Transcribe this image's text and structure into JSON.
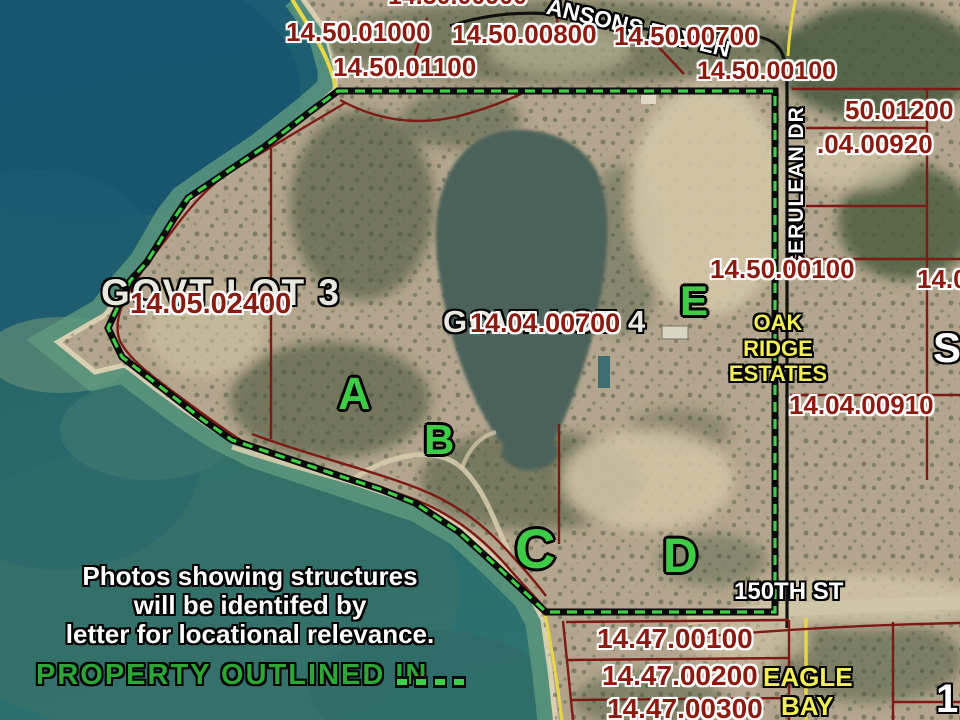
{
  "parcels": {
    "p14_50_00900": "14.50.00900",
    "p14_50_01000": "14.50.01000",
    "p14_50_00800": "14.50.00800",
    "p14_50_00700": "14.50.00700",
    "p14_50_01100": "14.50.01100",
    "p14_50_00100_top": "14.50.00100",
    "p50_01200": "50.01200",
    "p04_00920": ".04.00920",
    "p14_05_02400": "14.05.02400",
    "p14_04_00700": "14.04.00700",
    "p14_50_00100_mid": "14.50.00100",
    "p14_04_00910": "14.04.00910",
    "p14_0_partial": "14.0",
    "p14_47_00100": "14.47.00100",
    "p14_47_00200": "14.47.00200",
    "p14_47_00300": "14.47.00300"
  },
  "roads": {
    "bay_ln": "ANSONS BAY LN",
    "cerulean_dr": "CERULEAN DR",
    "street_150th": "150TH ST"
  },
  "underlays": {
    "govt_lot_3": "GOVT LOT 3",
    "govt_lot_4": "GOVT LOT 4",
    "s_partial": "S",
    "one_partial": "1"
  },
  "subdivisions": {
    "oak_ridge": [
      "OAK",
      "RIDGE",
      "ESTATES"
    ],
    "eagle_bay": [
      "EAGLE",
      "BAY"
    ]
  },
  "markers": {
    "a": "A",
    "b": "B",
    "c": "C",
    "d": "D",
    "e": "E"
  },
  "caption": {
    "line1": "Photos showing structures",
    "line2": "will be identifed by",
    "line3": "letter for locational relevance."
  },
  "legend": {
    "label": "PROPERTY OUTLINED IN"
  },
  "colors": {
    "parcel_text": "#8b1a10",
    "outline_green": "#3ecb46",
    "subdivision_yellow": "#f4ef55",
    "water_deep": "#1e5c74",
    "water_shallow": "#5f9a7e",
    "land_tan": "#b4a68e",
    "road_black": "#111111",
    "road_yellow": "#e7d645"
  }
}
